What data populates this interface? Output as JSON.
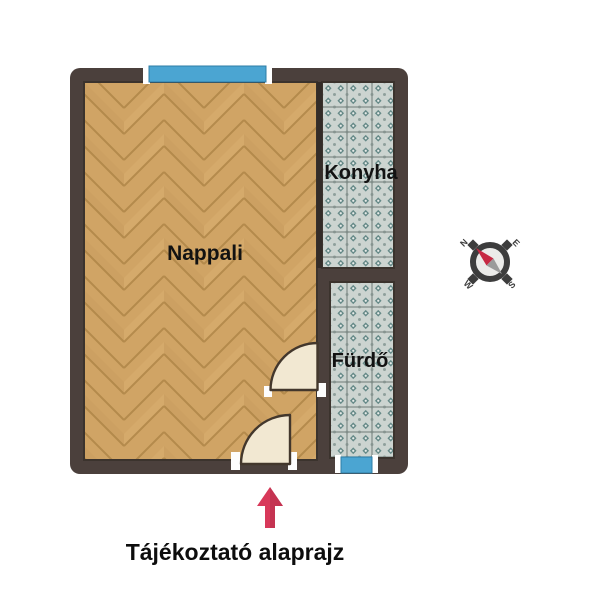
{
  "plan": {
    "rooms": [
      {
        "label": "Nappali",
        "floor": "herringbone-wood"
      },
      {
        "label": "Konyha",
        "floor": "ornamental-teal-tile"
      },
      {
        "label": "Fürdő",
        "floor": "ornamental-teal-tile"
      }
    ],
    "caption": "Tájékoztató alaprajz",
    "compass": {
      "n": "N",
      "e": "E",
      "s": "S",
      "w": "W"
    },
    "colors": {
      "wall": "#4b403c",
      "wood_base": "#d0a465",
      "wood_seam": "#a47c3e",
      "tile_base": "#ccd4d0",
      "tile_accent": "#547c7a",
      "window_blue": "#4ba5d2",
      "door_leaf": "#f2e8d2",
      "arrow_red": "#d8395a",
      "label_text": "#121212"
    }
  }
}
